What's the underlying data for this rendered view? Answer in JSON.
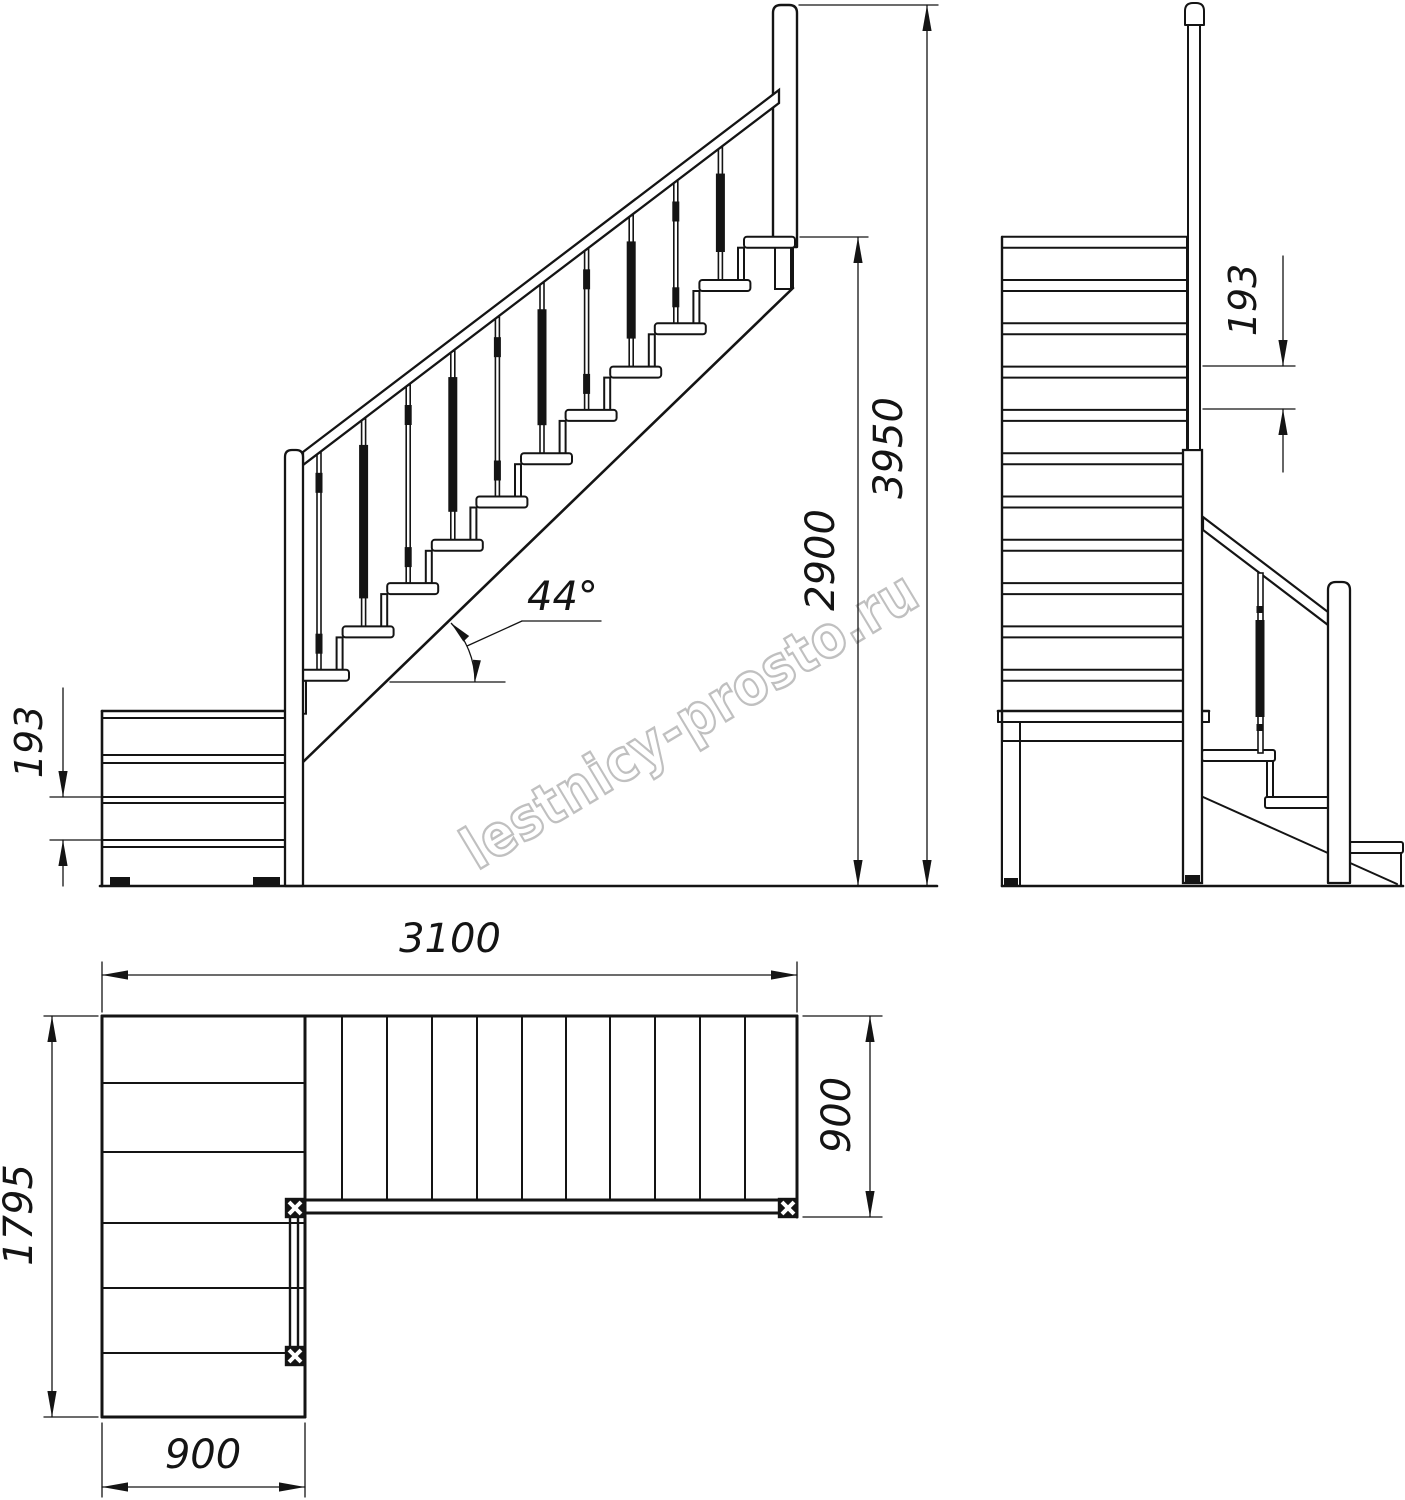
{
  "watermark": {
    "text": "lestnicy-prosto.ru"
  },
  "dimensions": {
    "side_view": {
      "riser": "193",
      "angle": "44°",
      "flight_rise": "2900",
      "overall_height": "3950"
    },
    "front_view": {
      "riser": "193"
    },
    "plan_view": {
      "main_flight_length": "3100",
      "overall_depth": "1795",
      "lower_flight_width": "900",
      "main_flight_width": "900"
    }
  }
}
